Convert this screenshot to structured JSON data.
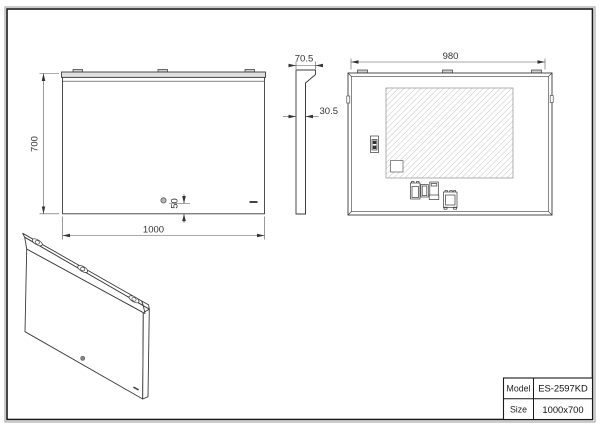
{
  "drawing": {
    "type": "technical-drawing",
    "product": "LED bathroom mirror",
    "colors": {
      "line": "#3a3a3a",
      "dim_line": "#555555",
      "hatch": "#c4c4c4",
      "fill_light": "#e0e0e0",
      "frame_outer": "#9a9a9a",
      "frame_inner": "#1a1a1a"
    },
    "front_view": {
      "height_dim": "700",
      "width_dim": "1000",
      "sensor_offset_dim": "50"
    },
    "side_view": {
      "depth_dim": "70.5",
      "thickness_dim": "30.5"
    },
    "back_view": {
      "width_dim": "980"
    },
    "title_block": {
      "model_label": "Model",
      "model_value": "ES-2597KD",
      "size_label": "Size",
      "size_value": "1000x700"
    }
  }
}
